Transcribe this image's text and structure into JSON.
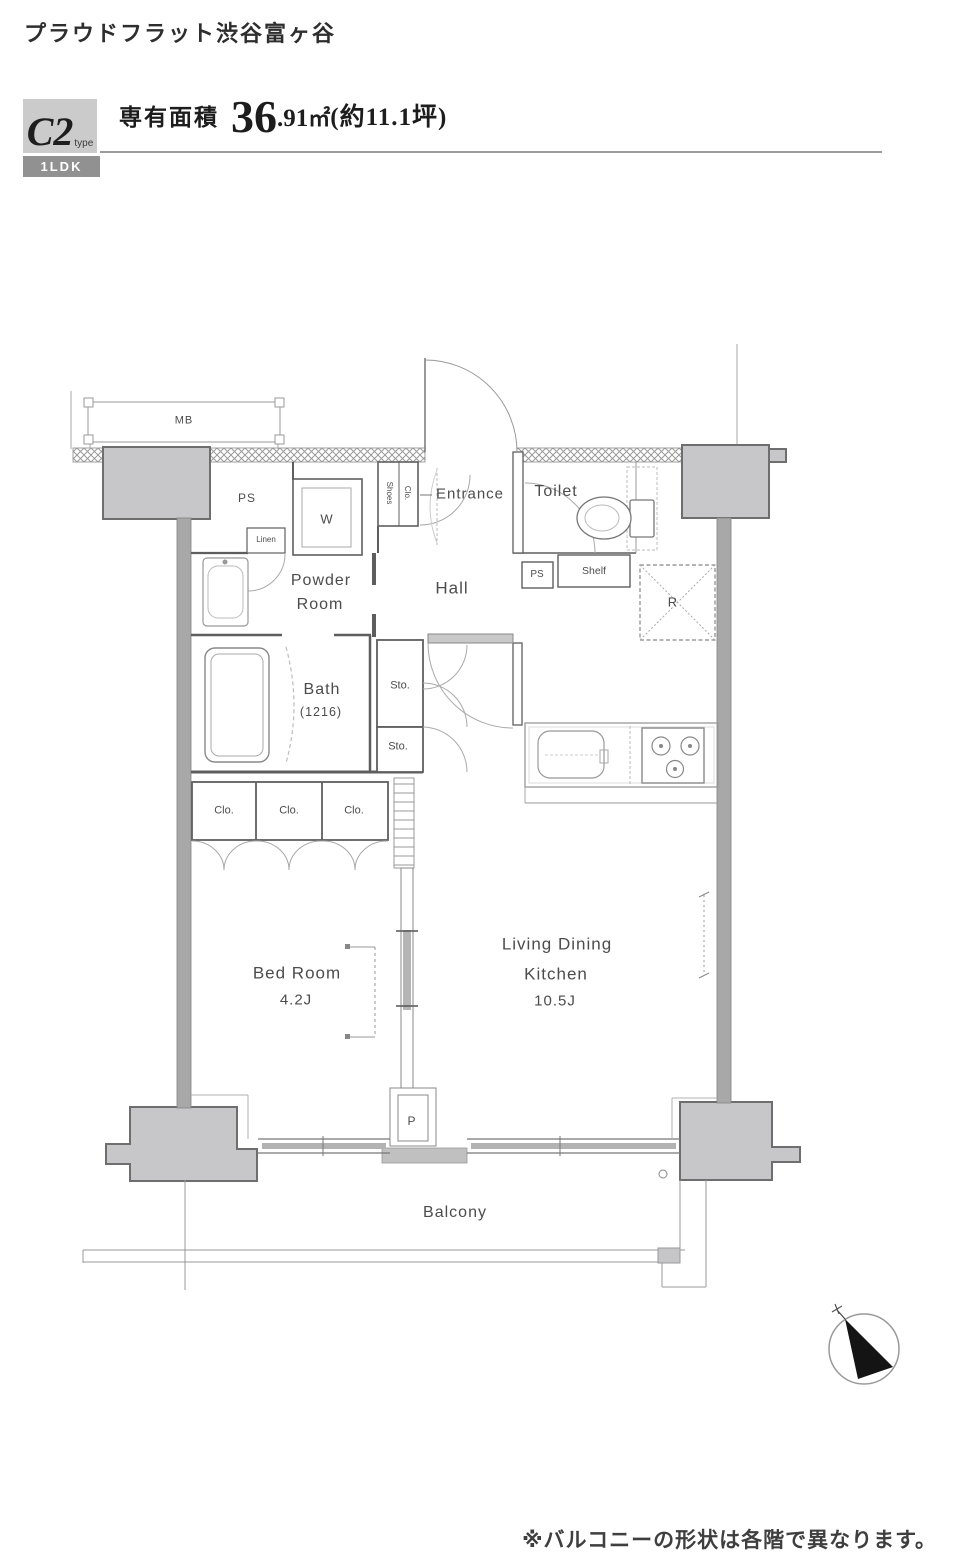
{
  "header": {
    "building_name": "プラウドフラット渋谷富ヶ谷",
    "type_code": "C2",
    "type_suffix": "type",
    "layout_badge": "1LDK",
    "area_label": "専有面積",
    "area_value_int": "36",
    "area_value_dec": ".91",
    "area_unit": "㎡",
    "area_tsubo": "(約11.1坪)"
  },
  "plan": {
    "mb": "MB",
    "ps_upper": "PS",
    "washer": "W",
    "linen": "Linen",
    "shoes_l1": "Shoes",
    "shoes_l2": "Clo.",
    "entrance": "Entrance",
    "toilet": "Toilet",
    "hall": "Hall",
    "powder_l1": "Powder",
    "powder_l2": "Room",
    "bath": "Bath",
    "bath_size": "(1216)",
    "sto_1": "Sto.",
    "sto_2": "Sto.",
    "ps_lower": "PS",
    "shelf": "Shelf",
    "fridge": "R",
    "clo_1": "Clo.",
    "clo_2": "Clo.",
    "clo_3": "Clo.",
    "bedroom_l1": "Bed Room",
    "bedroom_size": "4.2J",
    "ldk_l1": "Living Dining",
    "ldk_l2": "Kitchen",
    "ldk_size": "10.5J",
    "pipe": "P",
    "balcony": "Balcony"
  },
  "footer": {
    "note": "※バルコニーの形状は各階で異なります。"
  },
  "colors": {
    "type_box_bg": "#cbcbcb",
    "badge_bg": "#919191",
    "pillar_fill": "#c7c7ca",
    "pillar_stroke": "#6e6e6e",
    "wall_band": "#a8a8a8",
    "wall_dark": "#5e5e5e",
    "line_light": "#a0a0a0",
    "text_dark": "#2e2e2e",
    "text_mid": "#4c4c4c",
    "rule": "#9b9b9b"
  }
}
